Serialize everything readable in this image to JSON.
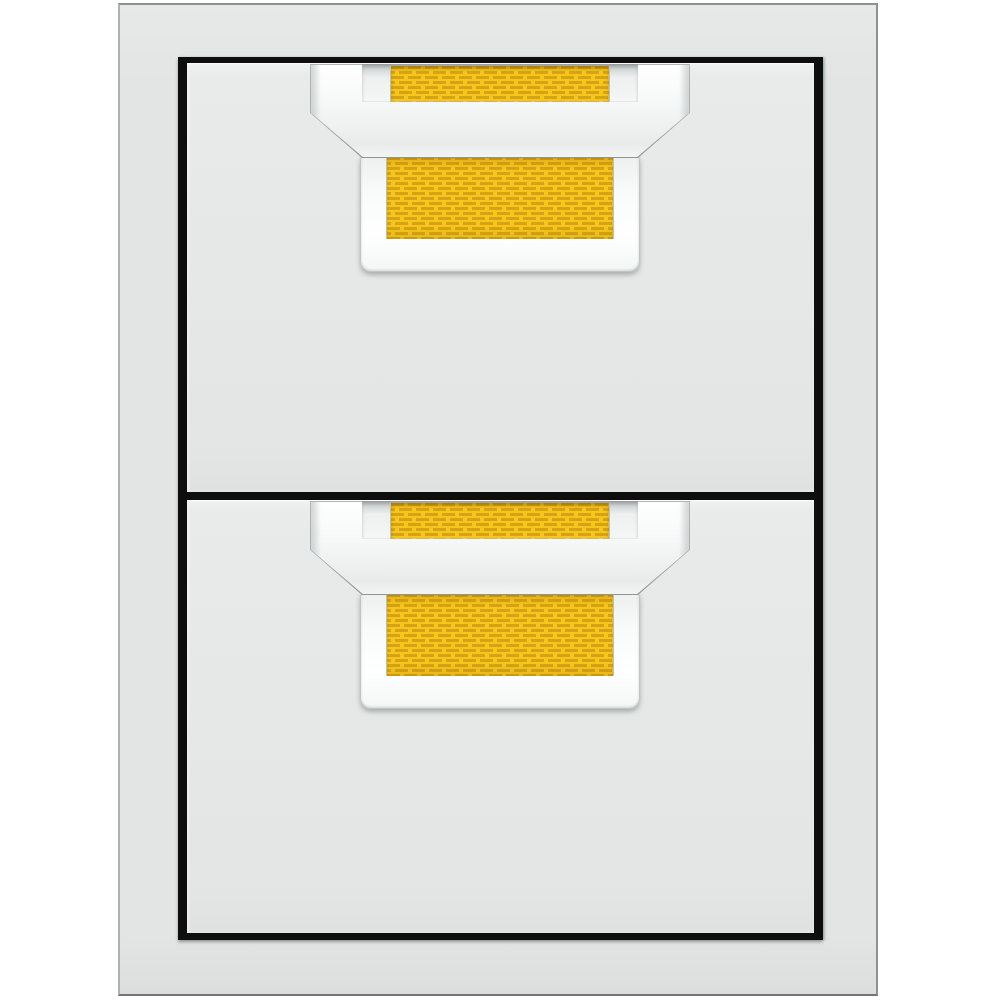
{
  "meta": {
    "subject": "double-storage-drawer-unit",
    "drawer_count": 2,
    "finish": "stainless-steel-with-yellow-accent"
  },
  "colors": {
    "background": "#ffffff",
    "frame": "#e3e5e5",
    "frame_edge_light": "#aeb2b2",
    "frame_edge_dark": "#8d9191",
    "border_black": "#0e0e0e",
    "drawer_face": "#e6e8e8",
    "drawer_face_light": "#eff1f1",
    "handle_white": "#f6f8f8",
    "accent_yellow": "#f8c51c",
    "accent_yellow_dark": "#d4a416",
    "bevel_gray": "#bfc4c4"
  },
  "drawers": [
    {
      "id": "upper",
      "label": "upper drawer with accent handle"
    },
    {
      "id": "lower",
      "label": "lower drawer with accent handle"
    }
  ]
}
